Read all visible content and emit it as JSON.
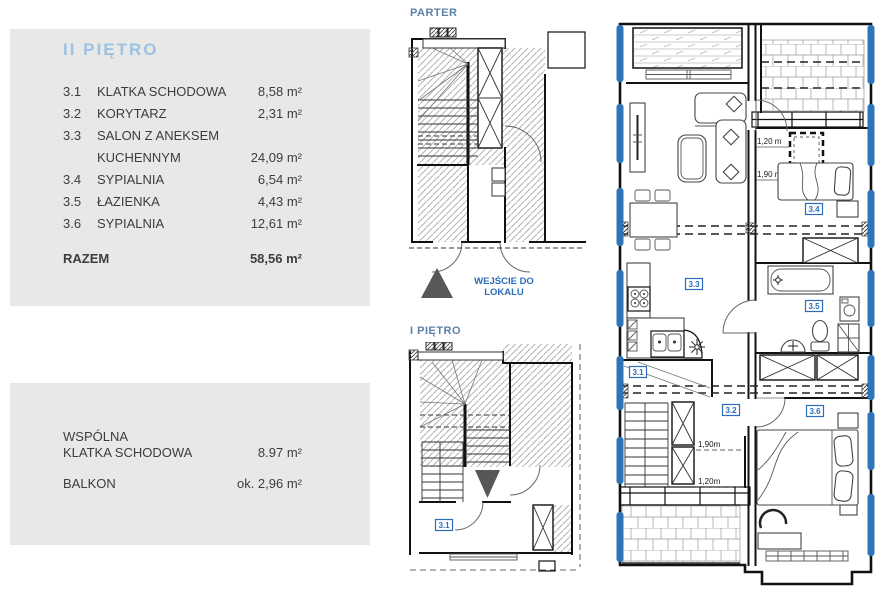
{
  "colors": {
    "panel_bg": "#e8e8e6",
    "heading_blue": "#9cc2e5",
    "plan_label_blue": "#5d82a6",
    "accent_blue": "#2a6ebb",
    "window_blue": "#2e74b8",
    "triangle_gray": "#57585a"
  },
  "legend": {
    "title": "II PIĘTRO",
    "rows": [
      {
        "no": "3.1",
        "name": "KLATKA SCHODOWA",
        "area": "8,58 m²"
      },
      {
        "no": "3.2",
        "name": "KORYTARZ",
        "area": "2,31 m²"
      },
      {
        "no": "3.3",
        "name": "SALON Z ANEKSEM",
        "name2": "KUCHENNYM",
        "area": "24,09 m²"
      },
      {
        "no": "3.4",
        "name": "SYPIALNIA",
        "area": "6,54 m²"
      },
      {
        "no": "3.5",
        "name": "ŁAZIENKA",
        "area": "4,43 m²"
      },
      {
        "no": "3.6",
        "name": "SYPIALNIA",
        "area": "12,61 m²"
      }
    ],
    "total_label": "RAZEM",
    "total_area": "58,56 m²"
  },
  "common": {
    "rows": [
      {
        "name1": "WSPÓLNA",
        "name2": "KLATKA SCHODOWA",
        "area": "8.97 m²"
      },
      {
        "name1": "BALKON",
        "name2": "",
        "area": "ok. 2,96 m²"
      }
    ]
  },
  "plans": {
    "parter": {
      "title": "PARTER"
    },
    "first_floor": {
      "title": "I PIĘTRO",
      "room_tag": "3.1"
    },
    "entrance_label": "WEJŚCIE DO LOKALU",
    "main": {
      "room_tags": [
        "3.1",
        "3.2",
        "3.3",
        "3.4",
        "3.5",
        "3.6"
      ],
      "dims": {
        "d1": "1,20 m",
        "d2": "1,90 m",
        "d3": "1,90m",
        "d4": "1,20m"
      }
    }
  }
}
